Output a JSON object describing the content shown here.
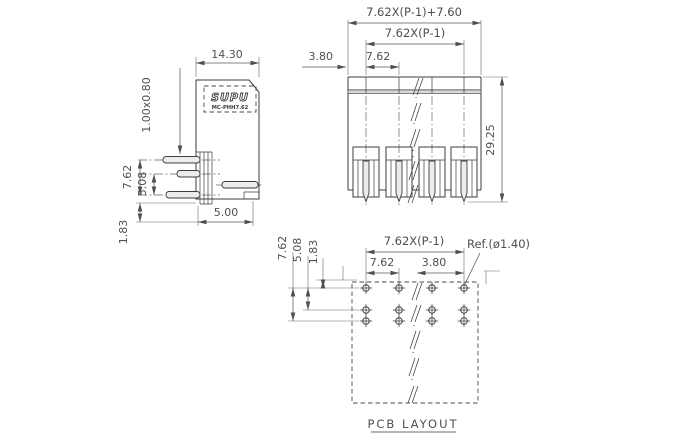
{
  "drawing": {
    "logo": {
      "brand": "SUPU",
      "model": "MC-PHH7.62"
    },
    "side_view": {
      "dims": {
        "body_width": "14.30",
        "pin_cross_section": "1.00x0.80",
        "pin_row_span": "7.62",
        "pin_row_spacing": "5.08",
        "standoff": "1.83",
        "depth": "5.00"
      }
    },
    "front_view": {
      "dims": {
        "overall_width": "7.62X(P-1)+7.60",
        "pin_span": "7.62X(P-1)",
        "pitch": "7.62",
        "edge_margin": "3.80",
        "height": "29.25"
      }
    },
    "pcb_layout": {
      "title": "PCB LAYOUT",
      "dims": {
        "row_span": "7.62",
        "row_spacing": "5.08",
        "edge_offset": "1.83",
        "pad_span": "7.62X(P-1)",
        "pitch": "7.62",
        "edge_margin": "3.80",
        "hole_ref": "Ref.(ø1.40)"
      }
    },
    "colors": {
      "object_line": "#3d3d3d",
      "dimension_line": "#5a5a5a",
      "text": "#4f4f4f",
      "background": "#ffffff"
    }
  }
}
